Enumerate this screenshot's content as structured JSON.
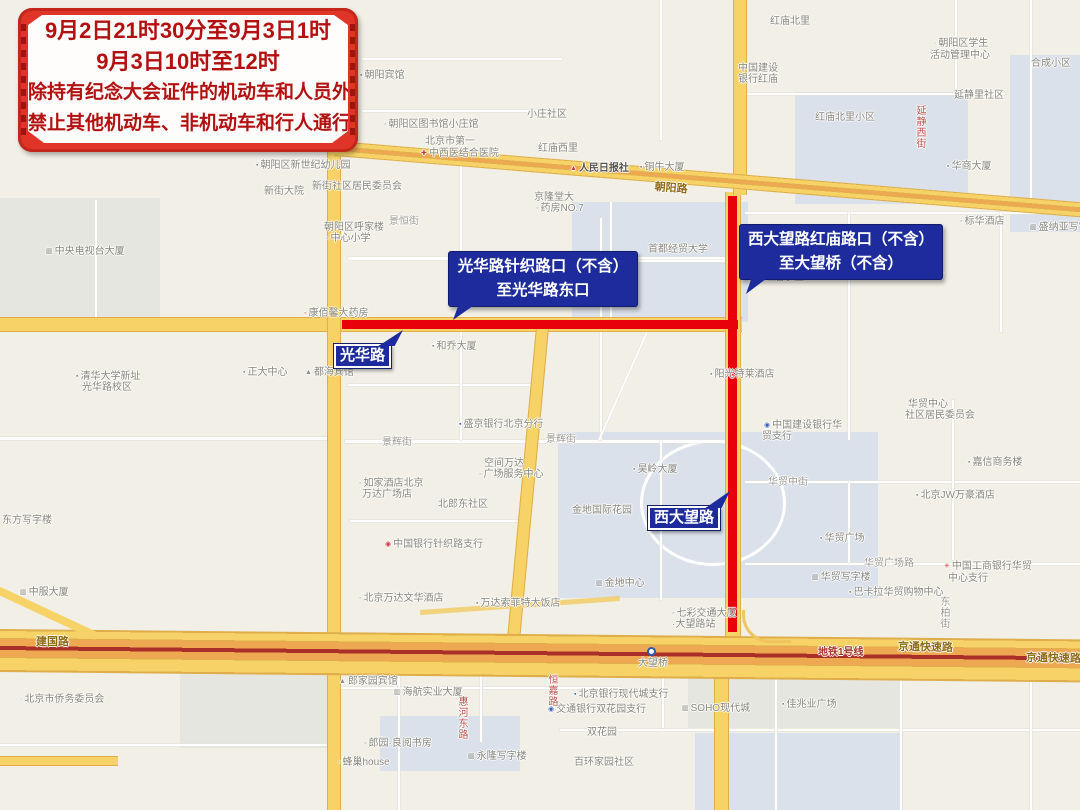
{
  "banner": {
    "lines": [
      "9月2日21时30分至9月3日1时",
      "9月3日10时至12时",
      "除持有纪念大会证件的机动车和人员外",
      "禁止其他机动车、非机动车和行人通行"
    ]
  },
  "callouts": {
    "guanghua": {
      "line1": "光华路针织路口（不含）",
      "line2": "至光华路东口"
    },
    "xidawang": {
      "line1": "西大望路红庙路口（不含）",
      "line2": "至大望桥（不含）"
    },
    "guanghua_tag": "光华路",
    "xidawang_tag": "西大望路"
  },
  "colors": {
    "restricted_route": "#e8000a",
    "road_yellow": "#f6d267",
    "road_orange": "#efa852",
    "subway_line": "#a8322c",
    "callout_bg": "#1d2b9c",
    "banner_frame": "#e03428",
    "banner_text": "#b31111"
  },
  "map": {
    "labels": [
      {
        "t": "朝阳宾馆",
        "x": 360,
        "y": 70,
        "icon": "▪"
      },
      {
        "t": "朝阳区图书馆小庄馆",
        "x": 384,
        "y": 119,
        "icon": "◦"
      },
      {
        "t": "小庄社区",
        "x": 527,
        "y": 109
      },
      {
        "t": "北京市第一",
        "x": 425,
        "y": 136
      },
      {
        "t": "中西医结合医院",
        "x": 421,
        "y": 148,
        "icon": "✚",
        "ic": "#d03a3a"
      },
      {
        "t": "红庙西里",
        "x": 538,
        "y": 143
      },
      {
        "t": "朝阳区新世纪幼儿园",
        "x": 256,
        "y": 160,
        "icon": "▪"
      },
      {
        "t": "新街大院",
        "x": 264,
        "y": 186
      },
      {
        "t": "新街社区居民委员会",
        "x": 312,
        "y": 181
      },
      {
        "t": "朝阳区呼家楼",
        "x": 324,
        "y": 222
      },
      {
        "t": "中心小学",
        "x": 326,
        "y": 233,
        "icon": "◦"
      },
      {
        "t": "景恒街",
        "x": 389,
        "y": 216,
        "cls": "street"
      },
      {
        "t": "人民日报社",
        "x": 570,
        "y": 163,
        "icon": "▲",
        "ic": "#d03a3a",
        "cls": "dark"
      },
      {
        "t": "铜牛大厦",
        "x": 640,
        "y": 162,
        "icon": "▪"
      },
      {
        "t": "红庙北里",
        "x": 770,
        "y": 16
      },
      {
        "t": "中国建设",
        "x": 738,
        "y": 63
      },
      {
        "t": "银行红庙",
        "x": 738,
        "y": 74
      },
      {
        "t": "朝阳区学生",
        "x": 934,
        "y": 38,
        "icon": "·"
      },
      {
        "t": "活动管理中心",
        "x": 930,
        "y": 50
      },
      {
        "t": "合成小区",
        "x": 1031,
        "y": 58
      },
      {
        "t": "延静里社区",
        "x": 954,
        "y": 90
      },
      {
        "t": "红庙北里小区",
        "x": 815,
        "y": 112
      },
      {
        "t": "华商大厦",
        "x": 947,
        "y": 161,
        "icon": "▪"
      },
      {
        "t": "标华酒店",
        "x": 960,
        "y": 216,
        "icon": "◦"
      },
      {
        "t": "盛纳亚写字楼",
        "x": 1030,
        "y": 222,
        "icon": "▥"
      },
      {
        "t": "首都经贸大学",
        "x": 648,
        "y": 244
      },
      {
        "t": "京隆堂大",
        "x": 534,
        "y": 192
      },
      {
        "t": "药房NO.7",
        "x": 536,
        "y": 203,
        "icon": "◦"
      },
      {
        "t": "红庙小区",
        "x": 764,
        "y": 272
      },
      {
        "t": "延静西街",
        "x": 914,
        "y": 105,
        "vert": true,
        "cls": "redv"
      },
      {
        "t": "阳光特莱酒店",
        "x": 710,
        "y": 369,
        "icon": "▪"
      },
      {
        "t": "中央电视台大厦",
        "x": 46,
        "y": 246,
        "icon": "▥"
      },
      {
        "t": "清华大学新址",
        "x": 76,
        "y": 371,
        "icon": "▪"
      },
      {
        "t": "光华路校区",
        "x": 82,
        "y": 382
      },
      {
        "t": "康佰馨大药房",
        "x": 304,
        "y": 308,
        "icon": "◦",
        "ic": "#d03a3a"
      },
      {
        "t": "正大中心",
        "x": 243,
        "y": 367,
        "icon": "▪"
      },
      {
        "t": "都海宾馆",
        "x": 305,
        "y": 367,
        "icon": "▲"
      },
      {
        "t": "和乔大厦",
        "x": 432,
        "y": 341,
        "icon": "▪"
      },
      {
        "t": "东方写字楼",
        "x": 2,
        "y": 515
      },
      {
        "t": "中服大厦",
        "x": 20,
        "y": 587,
        "icon": "▥"
      },
      {
        "t": "盛京银行北京分行",
        "x": 459,
        "y": 419,
        "icon": "▪",
        "ic": "#3a62c0"
      },
      {
        "t": "景辉街",
        "x": 382,
        "y": 437,
        "cls": "street"
      },
      {
        "t": "景辉街",
        "x": 546,
        "y": 434,
        "cls": "street"
      },
      {
        "t": "空间万达",
        "x": 484,
        "y": 458
      },
      {
        "t": "广场服务中心",
        "x": 479,
        "y": 469,
        "icon": "◦"
      },
      {
        "t": "如家酒店北京",
        "x": 359,
        "y": 478,
        "icon": "◦"
      },
      {
        "t": "万达广场店",
        "x": 362,
        "y": 489
      },
      {
        "t": "北郎东社区",
        "x": 438,
        "y": 499
      },
      {
        "t": "金地国际花园",
        "x": 572,
        "y": 505
      },
      {
        "t": "昊岭大厦",
        "x": 633,
        "y": 464,
        "icon": "▪"
      },
      {
        "t": "中国银行针织路支行",
        "x": 385,
        "y": 539,
        "icon": "◉",
        "ic": "#d03a3a"
      },
      {
        "t": "金地中心",
        "x": 596,
        "y": 578,
        "icon": "▥"
      },
      {
        "t": "北京万达文华酒店",
        "x": 359,
        "y": 593,
        "icon": "◦"
      },
      {
        "t": "万达索菲特大饭店",
        "x": 476,
        "y": 598,
        "icon": "▪"
      },
      {
        "t": "华贸中心",
        "x": 908,
        "y": 399
      },
      {
        "t": "社区居民委员会",
        "x": 905,
        "y": 410
      },
      {
        "t": "中国建设银行华",
        "x": 764,
        "y": 420,
        "icon": "◉",
        "ic": "#3a62c0"
      },
      {
        "t": "贸支行",
        "x": 762,
        "y": 431
      },
      {
        "t": "嘉信商务楼",
        "x": 968,
        "y": 457,
        "icon": "▪"
      },
      {
        "t": "华贸中街",
        "x": 768,
        "y": 477,
        "cls": "street"
      },
      {
        "t": "北京JW万豪酒店",
        "x": 916,
        "y": 490,
        "icon": "▪"
      },
      {
        "t": "华贸广场",
        "x": 820,
        "y": 533,
        "icon": "▪"
      },
      {
        "t": "华贸广场路",
        "x": 864,
        "y": 558,
        "cls": "street"
      },
      {
        "t": "华贸写字楼",
        "x": 812,
        "y": 572,
        "icon": "▥"
      },
      {
        "t": "中国工商银行华贸",
        "x": 944,
        "y": 561,
        "icon": "✳",
        "ic": "#d03a3a"
      },
      {
        "t": "中心支行",
        "x": 948,
        "y": 573
      },
      {
        "t": "巴卡拉华贸购物中心",
        "x": 849,
        "y": 587,
        "icon": "▪"
      },
      {
        "t": "东柏街",
        "x": 938,
        "y": 596,
        "vert": true,
        "cls": "street"
      },
      {
        "t": "七彩交通大厦",
        "x": 672,
        "y": 608,
        "icon": "◦"
      },
      {
        "t": "·大望路站",
        "x": 672,
        "y": 619
      },
      {
        "t": "大望桥",
        "x": 638,
        "y": 658
      },
      {
        "t": "海航实业大厦",
        "x": 394,
        "y": 687,
        "icon": "▥"
      },
      {
        "t": "北京市侨务委员会",
        "x": 20,
        "y": 694,
        "icon": "·"
      },
      {
        "t": "北京银行现代城支行",
        "x": 574,
        "y": 689,
        "icon": "▪",
        "ic": "#3a62c0"
      },
      {
        "t": "交通银行双花园支行",
        "x": 548,
        "y": 704,
        "icon": "◉",
        "ic": "#3a62c0"
      },
      {
        "t": "SOHO现代城",
        "x": 682,
        "y": 703,
        "icon": "▥"
      },
      {
        "t": "佳兆业广场",
        "x": 782,
        "y": 699,
        "icon": "▪"
      },
      {
        "t": "双花园",
        "x": 587,
        "y": 727
      },
      {
        "t": "百环家园社区",
        "x": 574,
        "y": 757
      },
      {
        "t": "郎园·良阅书房",
        "x": 364,
        "y": 738,
        "icon": "◦"
      },
      {
        "t": "郎家园宾馆",
        "x": 339,
        "y": 676,
        "icon": "▲"
      },
      {
        "t": "蜂巢house",
        "x": 338,
        "y": 757,
        "icon": "▫"
      },
      {
        "t": "永隆写字楼",
        "x": 468,
        "y": 751,
        "icon": "▥"
      },
      {
        "t": "惠河东路",
        "x": 456,
        "y": 696,
        "vert": true,
        "cls": "redv"
      },
      {
        "t": "恒嘉路",
        "x": 546,
        "y": 674,
        "vert": true,
        "cls": "redv"
      },
      {
        "t": "朝阳路",
        "x": 655,
        "y": 182,
        "cls": "road",
        "rot": 4.7
      },
      {
        "t": "建国路",
        "x": 36,
        "y": 637,
        "cls": "road"
      },
      {
        "t": "京通快速路",
        "x": 898,
        "y": 642,
        "cls": "road",
        "rot": 1
      },
      {
        "t": "京通快速路",
        "x": 1026,
        "y": 653,
        "cls": "road",
        "rot": 1
      },
      {
        "t": "地铁1号线",
        "x": 818,
        "y": 647,
        "cls": "metro"
      }
    ]
  }
}
